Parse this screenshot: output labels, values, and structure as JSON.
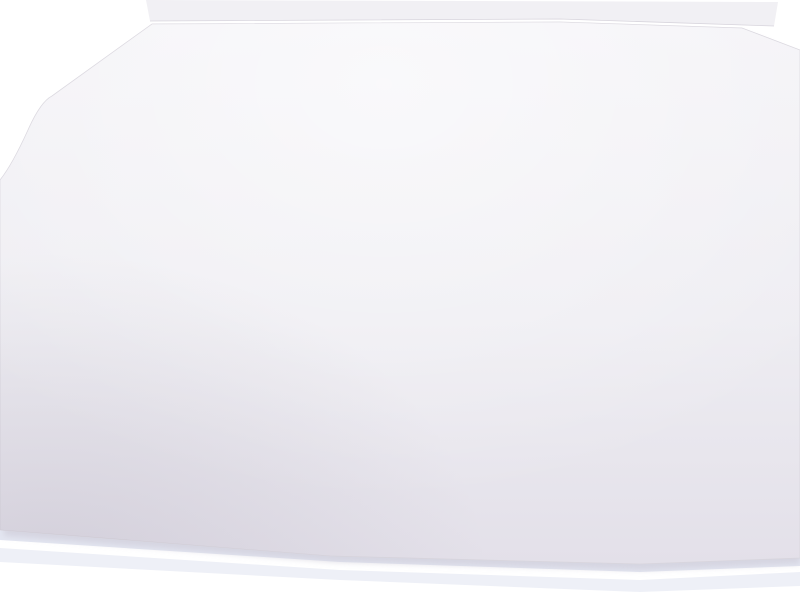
{
  "labels": [
    "veneer 0,6mm",
    "veneer 0,6mm",
    "veneer 0,6mm",
    "wood 2mm",
    "wood 3mm",
    "etched set",
    "Nautilus Scout 1:7",
    "210",
    "210",
    "90",
    "213",
    "714",
    "716",
    "442",
    "443",
    "513",
    "444",
    "444",
    "218a 218b",
    "219a 219b",
    "354",
    "357",
    "358",
    "359",
    "360 361",
    "429 432 435",
    "429",
    "446",
    "407",
    "356",
    "327",
    "419",
    "436",
    "414",
    "416",
    "274",
    "274",
    "253",
    "119 120 121",
    "129 130 131 132 133",
    "379",
    "379",
    "409a",
    "377",
    "378",
    "377",
    "377",
    "378",
    "377",
    "361 362 363",
    "191a",
    "388",
    "192",
    "381",
    "382",
    "372",
    "373",
    "393",
    "191b",
    "385",
    "386",
    "387"
  ],
  "colors": {
    "background": "#ffffff",
    "paper": "#efeef3",
    "paper_shade": "#dcd9e2",
    "ink_light": "#b4adbe",
    "ink": "#8d8596",
    "ink_dark": "#5b5566",
    "part_black": "#312d3a",
    "under_sheet": "#e3e6f1"
  }
}
